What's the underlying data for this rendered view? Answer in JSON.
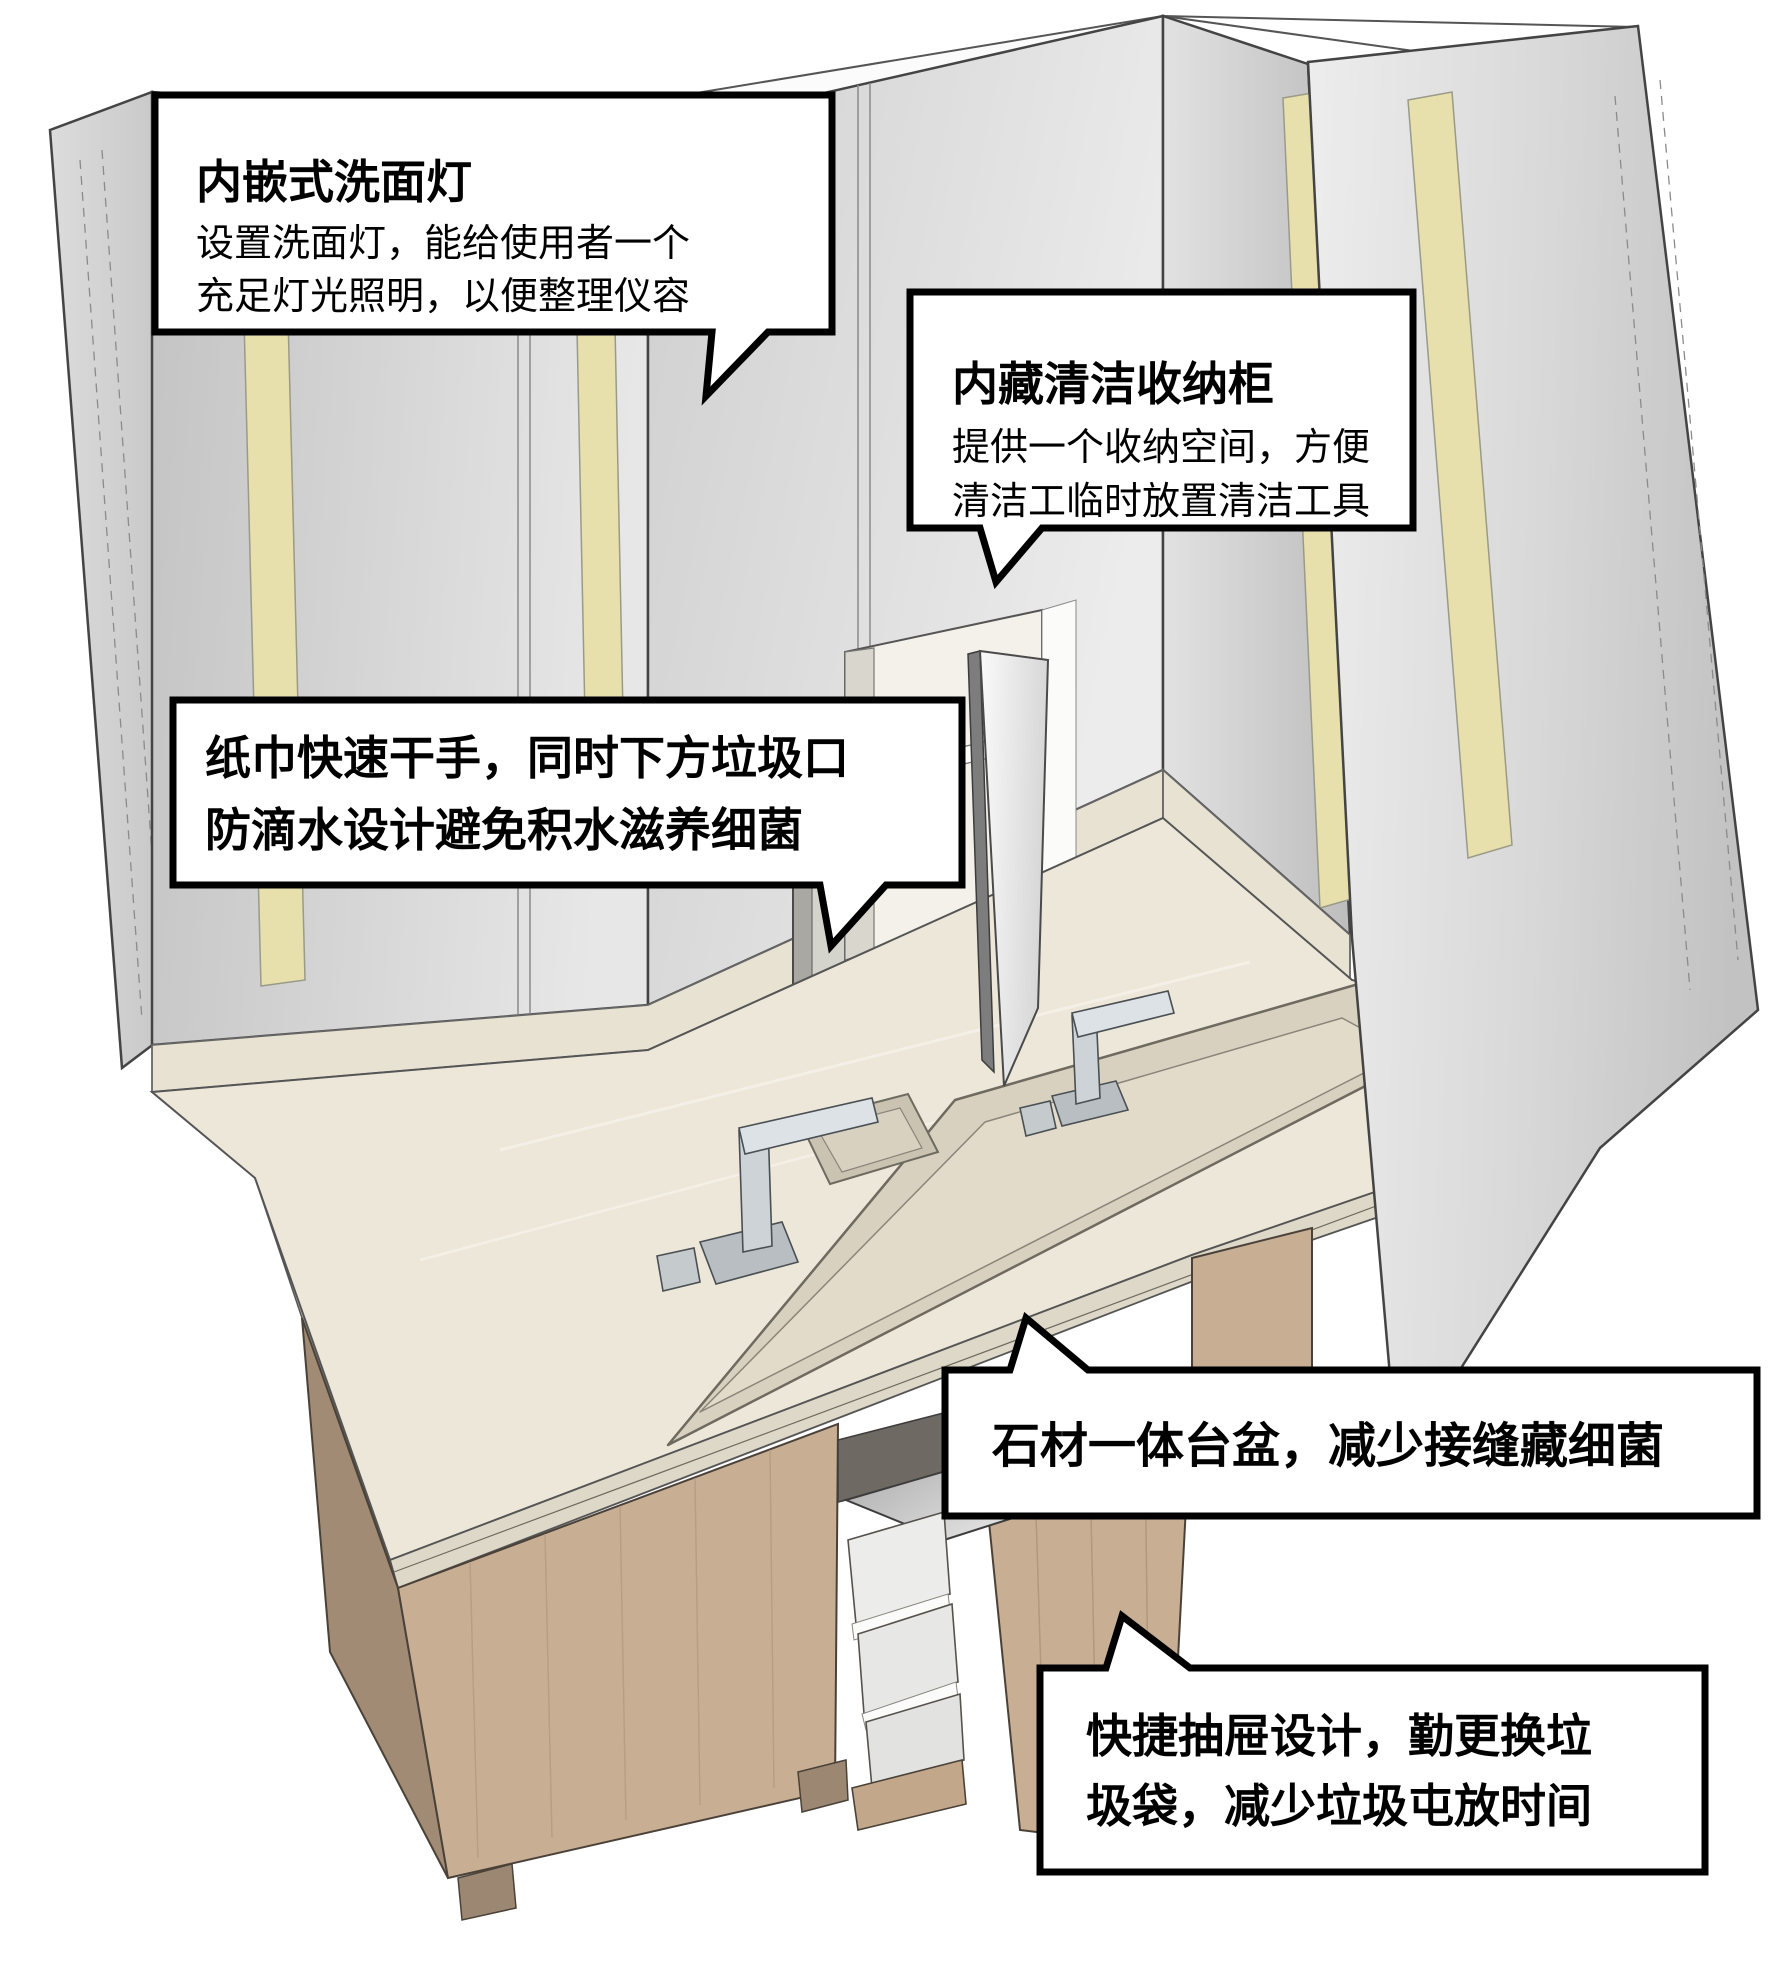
{
  "callouts": {
    "recessed_mirror_light": {
      "title": "内嵌式洗面灯",
      "body_line1": "设置洗面灯，能给使用者一个",
      "body_line2": "充足灯光照明，以便整理仪容"
    },
    "hidden_cleaning_cabinet": {
      "title": "内藏清洁收纳柜",
      "body_line1": "提供一个收纳空间，方便",
      "body_line2": "清洁工临时放置清洁工具"
    },
    "paper_towel_dryer": {
      "line1": "纸巾快速干手，同时下方垃圾口",
      "line2": "防滴水设计避免积水滋养细菌"
    },
    "integrated_stone_basin": {
      "line1": "石材一体台盆，减少接缝藏细菌"
    },
    "quick_drawer": {
      "line1": "快捷抽屉设计，勤更换垃",
      "line2": "圾袋，减少垃圾屯放时间"
    }
  },
  "colors": {
    "led_strip": "#e7e0ad",
    "countertop": "#ece7d9",
    "counter_edge": "#ded8c8",
    "basin_wall": "#d8d1bf",
    "basin_floor": "#e2dbca",
    "splash": "#e8e2d3",
    "wood": "#c8ae93",
    "wood_dark": "#a18b74",
    "callout_bg": "#ffffff",
    "callout_border": "#000000"
  }
}
